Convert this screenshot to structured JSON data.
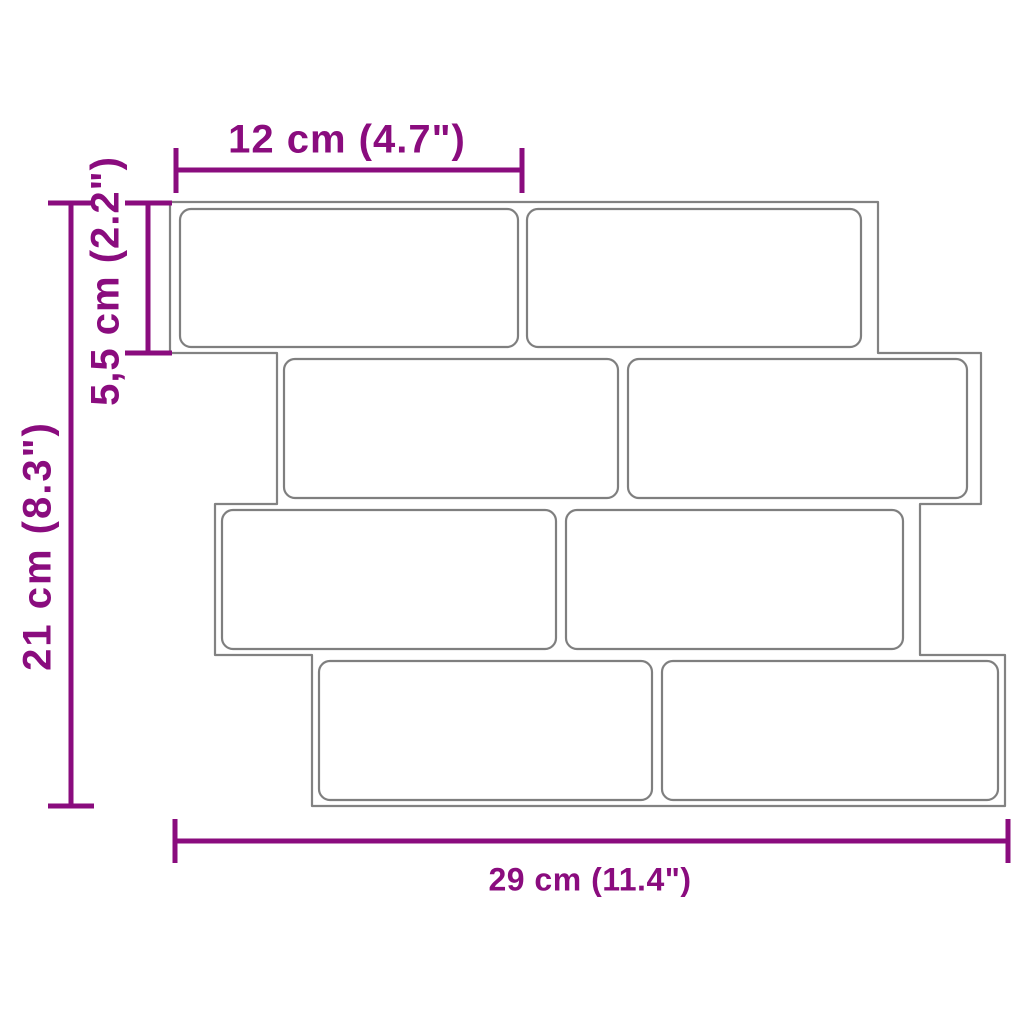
{
  "page": {
    "background_color": "#ffffff"
  },
  "colors": {
    "dimension_accent": "#8A0C7E",
    "panel_outline": "#828282",
    "brick_outline": "#7f7f7f",
    "brick_fill": "#ffffff"
  },
  "diagram": {
    "description": "Dimension drawing of a wall tile panel with 8 subway bricks in 4 offset rows",
    "rows": 4,
    "bricks_per_row": 2,
    "brick_count": 8,
    "labels": {
      "brick_width": {
        "text": "12 cm (4.7\")",
        "position": "top",
        "orientation": "horizontal"
      },
      "brick_height": {
        "text": "5,5 cm (2.2\")",
        "position": "left-inner",
        "orientation": "vertical"
      },
      "panel_height": {
        "text": "21 cm (8.3\")",
        "position": "left-outer",
        "orientation": "vertical"
      },
      "panel_width": {
        "text": "29 cm (11.4\")",
        "position": "bottom",
        "orientation": "horizontal"
      }
    }
  }
}
